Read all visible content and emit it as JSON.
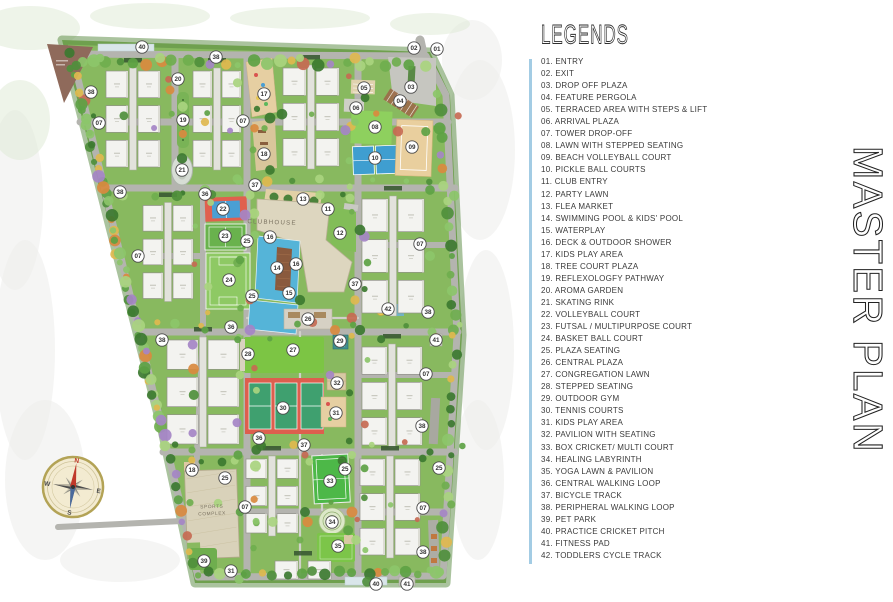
{
  "legend": {
    "title": "LEGENDS",
    "accent_color": "#a3cce4",
    "items": [
      {
        "num": "01",
        "label": "ENTRY"
      },
      {
        "num": "02",
        "label": "EXIT"
      },
      {
        "num": "03",
        "label": "DROP OFF PLAZA"
      },
      {
        "num": "04",
        "label": "FEATURE PERGOLA"
      },
      {
        "num": "05",
        "label": "TERRACED AREA WITH STEPS & LIFT"
      },
      {
        "num": "06",
        "label": "ARRIVAL PLAZA"
      },
      {
        "num": "07",
        "label": "TOWER DROP-OFF"
      },
      {
        "num": "08",
        "label": "LAWN WITH STEPPED SEATING"
      },
      {
        "num": "09",
        "label": "BEACH VOLLEYBALL COURT"
      },
      {
        "num": "10",
        "label": "PICKLE BALL COURTS"
      },
      {
        "num": "11",
        "label": "CLUB ENTRY"
      },
      {
        "num": "12",
        "label": "PARTY LAWN"
      },
      {
        "num": "13",
        "label": "FLEA MARKET"
      },
      {
        "num": "14",
        "label": "SWIMMING POOL & KIDS' POOL"
      },
      {
        "num": "15",
        "label": "WATERPLAY"
      },
      {
        "num": "16",
        "label": "DECK & OUTDOOR SHOWER"
      },
      {
        "num": "17",
        "label": "KIDS PLAY AREA"
      },
      {
        "num": "18",
        "label": "TREE COURT PLAZA"
      },
      {
        "num": "19",
        "label": "REFLEXOLOGFY PATHWAY"
      },
      {
        "num": "20",
        "label": "AROMA GARDEN"
      },
      {
        "num": "21",
        "label": "SKATING RINK"
      },
      {
        "num": "22",
        "label": "VOLLEYBALL COURT"
      },
      {
        "num": "23",
        "label": "FUTSAL / MULTIPURPOSE COURT"
      },
      {
        "num": "24",
        "label": "BASKET BALL COURT"
      },
      {
        "num": "25",
        "label": "PLAZA SEATING"
      },
      {
        "num": "26",
        "label": "CENTRAL PLAZA"
      },
      {
        "num": "27",
        "label": "CONGREGATION LAWN"
      },
      {
        "num": "28",
        "label": "STEPPED SEATING"
      },
      {
        "num": "29",
        "label": "OUTDOOR GYM"
      },
      {
        "num": "30",
        "label": "TENNIS COURTS"
      },
      {
        "num": "31",
        "label": "KIDS PLAY AREA"
      },
      {
        "num": "32",
        "label": "PAVILION WITH SEATING"
      },
      {
        "num": "33",
        "label": "BOX CRICKET/ MULTI COURT"
      },
      {
        "num": "34",
        "label": "HEALING LABYRINTH"
      },
      {
        "num": "35",
        "label": "YOGA LAWN & PAVILION"
      },
      {
        "num": "36",
        "label": "CENTRAL WALKING LOOP"
      },
      {
        "num": "37",
        "label": "BICYCLE TRACK"
      },
      {
        "num": "38",
        "label": "PERIPHERAL WALKING LOOP"
      },
      {
        "num": "39",
        "label": "PET PARK"
      },
      {
        "num": "40",
        "label": "PRACTICE CRICKET PITCH"
      },
      {
        "num": "41",
        "label": "FITNESS PAD"
      },
      {
        "num": "42",
        "label": "TODDLERS CYCLE TRACK"
      }
    ]
  },
  "side_title": {
    "text": "MASTER PLAN",
    "color": "#2a2a2a"
  },
  "map": {
    "clubhouse_label": "CLUBHOUSE",
    "sports_complex_label": "SPORTS COMPLEX",
    "compass": {
      "n": "N",
      "e": "E",
      "s": "S",
      "w": "W"
    },
    "colors": {
      "grass": "#88b95f",
      "hedge": "#55883d",
      "road": "#b4b4af",
      "path": "#d0d0c9",
      "building": "#f3f3f0",
      "building_stroke": "#92928a",
      "spine": "#e2e2dc",
      "clubhouse": "#ddd6bf",
      "clubhouse_stroke": "#b9b094",
      "pool": "#55b4d8",
      "deck": "#8a5a3d",
      "court_red": "#e0604e",
      "court_green": "#3fa06f",
      "court_blue": "#4a9fd4",
      "futsal": "#69b24d",
      "basket": "#8ec964",
      "lawn": "#7cc544",
      "lawn_light": "#8ed05e",
      "sand": "#e9cf9e",
      "plaza_tan": "#ddc9a2",
      "gym": "#3f8f8f",
      "marker_fill": "#ffffff",
      "marker_stroke": "#4a4a4a",
      "marker_text": "#333333",
      "compass_face": "#f3ebd1",
      "compass_ring": "#b3a356",
      "compass_n": "#c0392b",
      "label_text": "#7a7260"
    },
    "markers": [
      {
        "n": "01",
        "x": 437,
        "y": 49
      },
      {
        "n": "02",
        "x": 414,
        "y": 48
      },
      {
        "n": "03",
        "x": 411,
        "y": 87
      },
      {
        "n": "04",
        "x": 400,
        "y": 101
      },
      {
        "n": "05",
        "x": 364,
        "y": 88
      },
      {
        "n": "06",
        "x": 356,
        "y": 108
      },
      {
        "n": "07",
        "x": 99,
        "y": 123
      },
      {
        "n": "07",
        "x": 243,
        "y": 121
      },
      {
        "n": "07",
        "x": 138,
        "y": 256
      },
      {
        "n": "07",
        "x": 420,
        "y": 244
      },
      {
        "n": "07",
        "x": 426,
        "y": 374
      },
      {
        "n": "07",
        "x": 245,
        "y": 507
      },
      {
        "n": "07",
        "x": 423,
        "y": 508
      },
      {
        "n": "08",
        "x": 375,
        "y": 127
      },
      {
        "n": "09",
        "x": 412,
        "y": 147
      },
      {
        "n": "10",
        "x": 375,
        "y": 158
      },
      {
        "n": "11",
        "x": 328,
        "y": 209
      },
      {
        "n": "12",
        "x": 340,
        "y": 233
      },
      {
        "n": "13",
        "x": 303,
        "y": 199
      },
      {
        "n": "14",
        "x": 277,
        "y": 268
      },
      {
        "n": "15",
        "x": 289,
        "y": 293
      },
      {
        "n": "16",
        "x": 270,
        "y": 237
      },
      {
        "n": "16",
        "x": 296,
        "y": 264
      },
      {
        "n": "17",
        "x": 264,
        "y": 94
      },
      {
        "n": "18",
        "x": 264,
        "y": 154
      },
      {
        "n": "18",
        "x": 192,
        "y": 470
      },
      {
        "n": "19",
        "x": 183,
        "y": 120
      },
      {
        "n": "20",
        "x": 178,
        "y": 79
      },
      {
        "n": "21",
        "x": 182,
        "y": 170
      },
      {
        "n": "22",
        "x": 223,
        "y": 209
      },
      {
        "n": "23",
        "x": 225,
        "y": 236
      },
      {
        "n": "24",
        "x": 229,
        "y": 280
      },
      {
        "n": "25",
        "x": 247,
        "y": 241
      },
      {
        "n": "25",
        "x": 252,
        "y": 296
      },
      {
        "n": "25",
        "x": 345,
        "y": 469
      },
      {
        "n": "25",
        "x": 439,
        "y": 468
      },
      {
        "n": "25",
        "x": 225,
        "y": 478
      },
      {
        "n": "26",
        "x": 308,
        "y": 319
      },
      {
        "n": "27",
        "x": 293,
        "y": 350
      },
      {
        "n": "28",
        "x": 248,
        "y": 354
      },
      {
        "n": "29",
        "x": 340,
        "y": 341
      },
      {
        "n": "30",
        "x": 283,
        "y": 408
      },
      {
        "n": "31",
        "x": 336,
        "y": 413
      },
      {
        "n": "31",
        "x": 231,
        "y": 571
      },
      {
        "n": "32",
        "x": 337,
        "y": 383
      },
      {
        "n": "33",
        "x": 330,
        "y": 481
      },
      {
        "n": "34",
        "x": 332,
        "y": 522
      },
      {
        "n": "35",
        "x": 338,
        "y": 546
      },
      {
        "n": "36",
        "x": 205,
        "y": 194
      },
      {
        "n": "36",
        "x": 231,
        "y": 327
      },
      {
        "n": "36",
        "x": 259,
        "y": 438
      },
      {
        "n": "37",
        "x": 255,
        "y": 185
      },
      {
        "n": "37",
        "x": 355,
        "y": 284
      },
      {
        "n": "37",
        "x": 304,
        "y": 445
      },
      {
        "n": "38",
        "x": 91,
        "y": 92
      },
      {
        "n": "38",
        "x": 216,
        "y": 57
      },
      {
        "n": "38",
        "x": 120,
        "y": 192
      },
      {
        "n": "38",
        "x": 162,
        "y": 340
      },
      {
        "n": "38",
        "x": 428,
        "y": 312
      },
      {
        "n": "38",
        "x": 422,
        "y": 426
      },
      {
        "n": "38",
        "x": 423,
        "y": 552
      },
      {
        "n": "39",
        "x": 204,
        "y": 561
      },
      {
        "n": "40",
        "x": 142,
        "y": 47
      },
      {
        "n": "40",
        "x": 376,
        "y": 584
      },
      {
        "n": "41",
        "x": 436,
        "y": 340
      },
      {
        "n": "41",
        "x": 407,
        "y": 584
      },
      {
        "n": "42",
        "x": 388,
        "y": 309
      }
    ]
  }
}
